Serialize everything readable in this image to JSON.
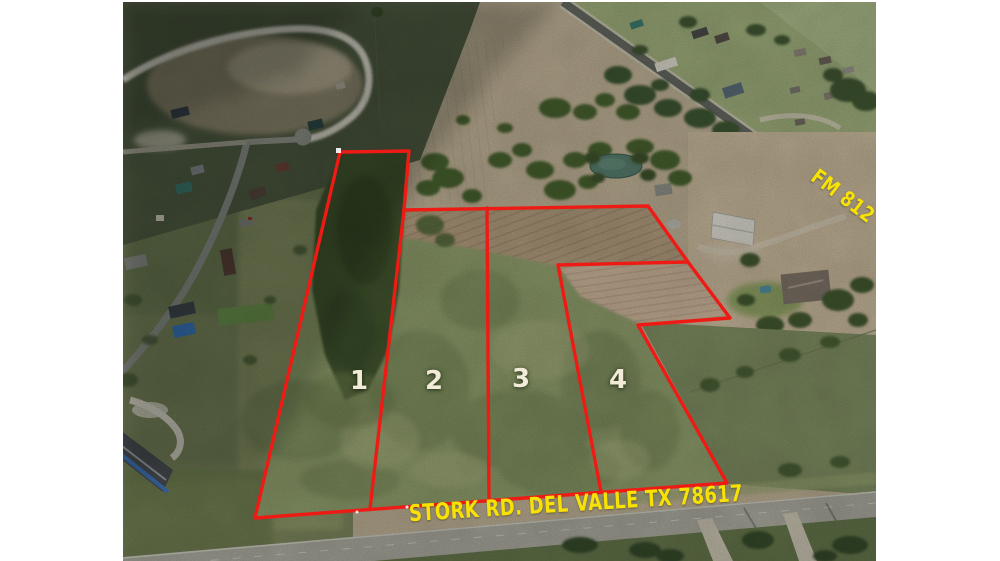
{
  "annotations": {
    "parcels": [
      {
        "label": "1"
      },
      {
        "label": "2"
      },
      {
        "label": "3"
      },
      {
        "label": "4"
      }
    ],
    "road_labels": [
      {
        "label": "STORK RD. DEL VALLE TX 78617"
      },
      {
        "label": "FM 812"
      }
    ],
    "colors": {
      "boundary_red": "#ee1b15",
      "label_yellow": "#f8e205",
      "parcel_number_cream": "#f2ebd8"
    }
  }
}
